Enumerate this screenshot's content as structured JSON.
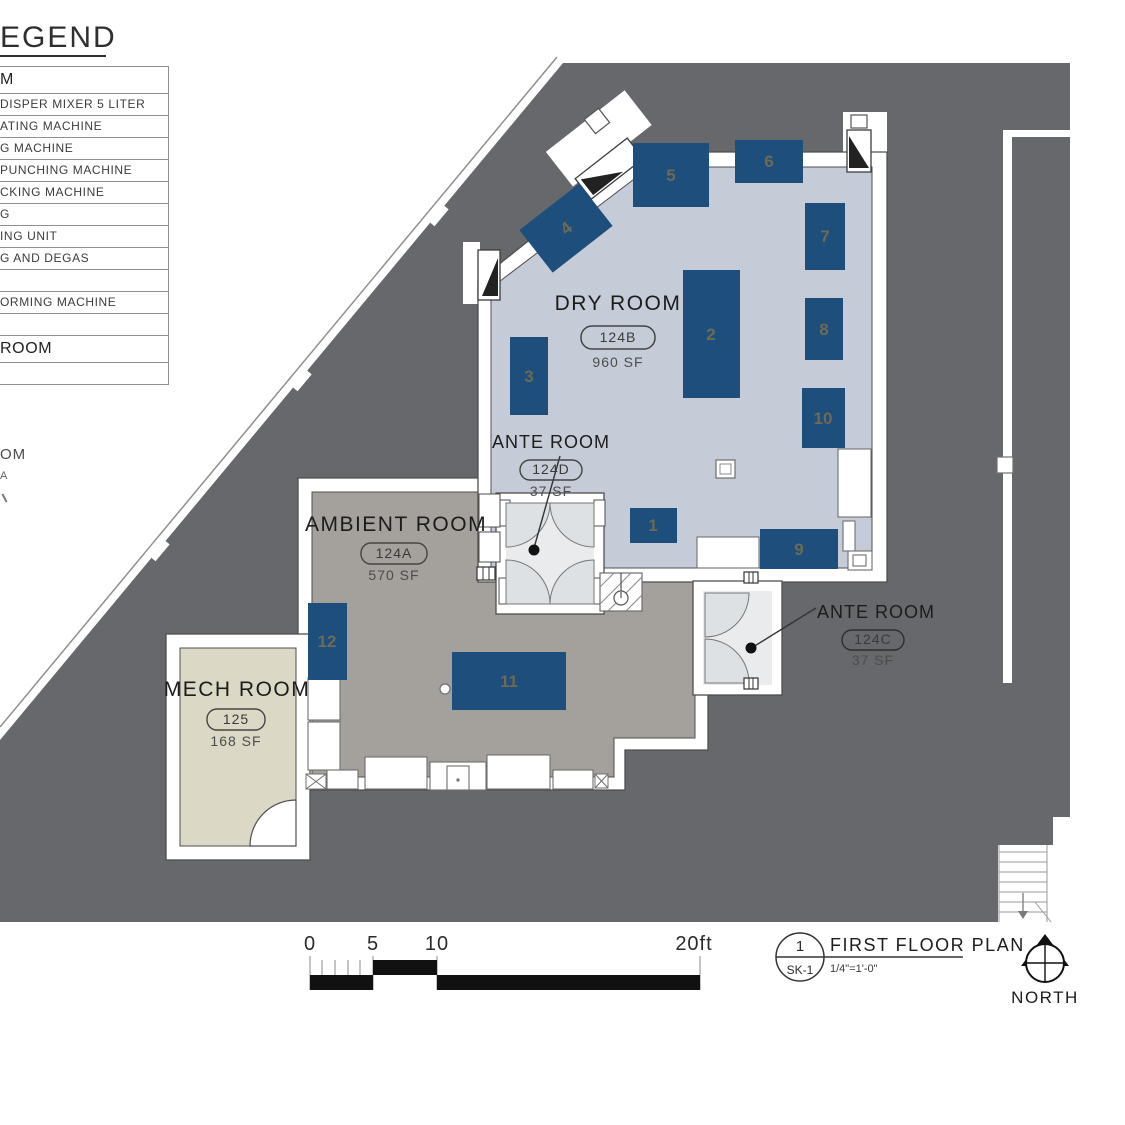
{
  "colors": {
    "site_gray": "#66686b",
    "dry_room_floor": "#c5ccd8",
    "ambient_room_floor": "#a4a09b",
    "mech_room_floor": "#dcd8c6",
    "vestibule_fill": "#e9ebed",
    "door_swing_fill": "#dde1e4",
    "equipment_blue": "#1e4e7b",
    "equipment_number": "#6e6a55",
    "wall_stroke": "#4f4f4f"
  },
  "legend": {
    "title": "EGEND",
    "rows": [
      {
        "label": "M"
      },
      {
        "label": "DISPER MIXER 5 LITER"
      },
      {
        "label": "ATING MACHINE"
      },
      {
        "label": "G MACHINE"
      },
      {
        "label": "PUNCHING MACHINE"
      },
      {
        "label": "CKING MACHINE"
      },
      {
        "label": "G"
      },
      {
        "label": "ING UNIT"
      },
      {
        "label": "G AND DEGAS"
      },
      {
        "label": ""
      },
      {
        "label": "ORMING MACHINE"
      },
      {
        "label": ""
      },
      {
        "label": "ROOM"
      },
      {
        "label": ""
      }
    ]
  },
  "edge_fragments": {
    "text_1": "OM",
    "text_2": "A"
  },
  "rooms": {
    "dry": {
      "name": "DRY ROOM",
      "tag": "124B",
      "area": "960 SF"
    },
    "ante_d": {
      "name": "ANTE ROOM",
      "tag": "124D",
      "area": "37 SF"
    },
    "ambient": {
      "name": "AMBIENT ROOM",
      "tag": "124A",
      "area": "570 SF"
    },
    "ante_c": {
      "name": "ANTE ROOM",
      "tag": "124C",
      "area": "37 SF"
    },
    "mech": {
      "name": "MECH ROOM",
      "tag": "125",
      "area": "168 SF"
    }
  },
  "equipment": {
    "n1": "1",
    "n2": "2",
    "n3": "3",
    "n4": "4",
    "n5": "5",
    "n6": "6",
    "n7": "7",
    "n8": "8",
    "n9": "9",
    "n10": "10",
    "n11": "11",
    "n12": "12"
  },
  "scale_bar": {
    "tick_0": "0",
    "tick_5": "5",
    "tick_10": "10",
    "tick_20": "20ft"
  },
  "title_block": {
    "detail_number": "1",
    "sheet": "SK-1",
    "title": "FIRST FLOOR PLAN",
    "scale": "1/4\"=1'-0\""
  },
  "north_label": "NORTH"
}
